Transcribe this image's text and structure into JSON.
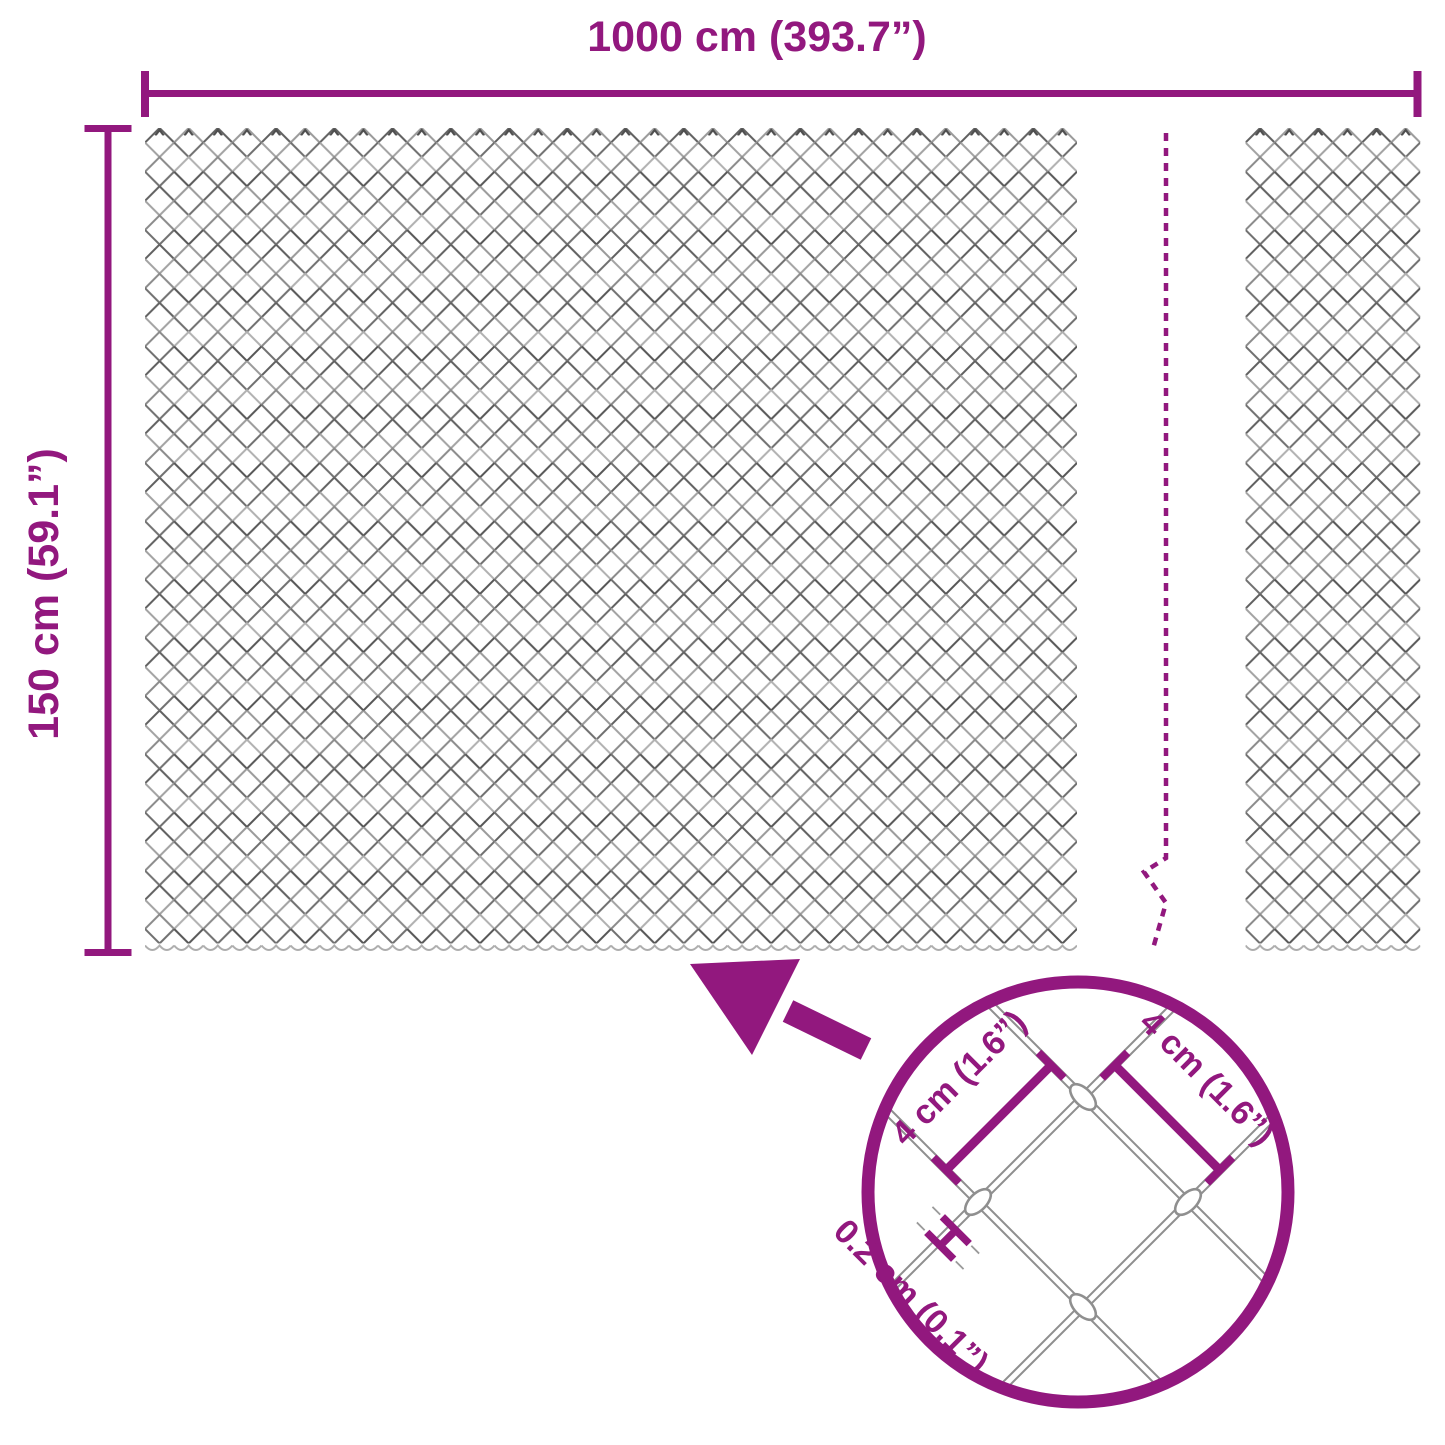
{
  "labels": {
    "total_width": "1000 cm (393.7”)",
    "total_height": "150 cm (59.1”)",
    "detail_mesh_size_left": "4 cm (1.6”)",
    "detail_mesh_size_right": "4 cm (1.6”)",
    "wire_thickness": "0.2 cm (0.1”)"
  },
  "colors": {
    "accent": "#92187E",
    "wire_gray": "#8F8F8F",
    "mesh_dark": "#606060",
    "mesh_light": "#A8A8A8"
  }
}
